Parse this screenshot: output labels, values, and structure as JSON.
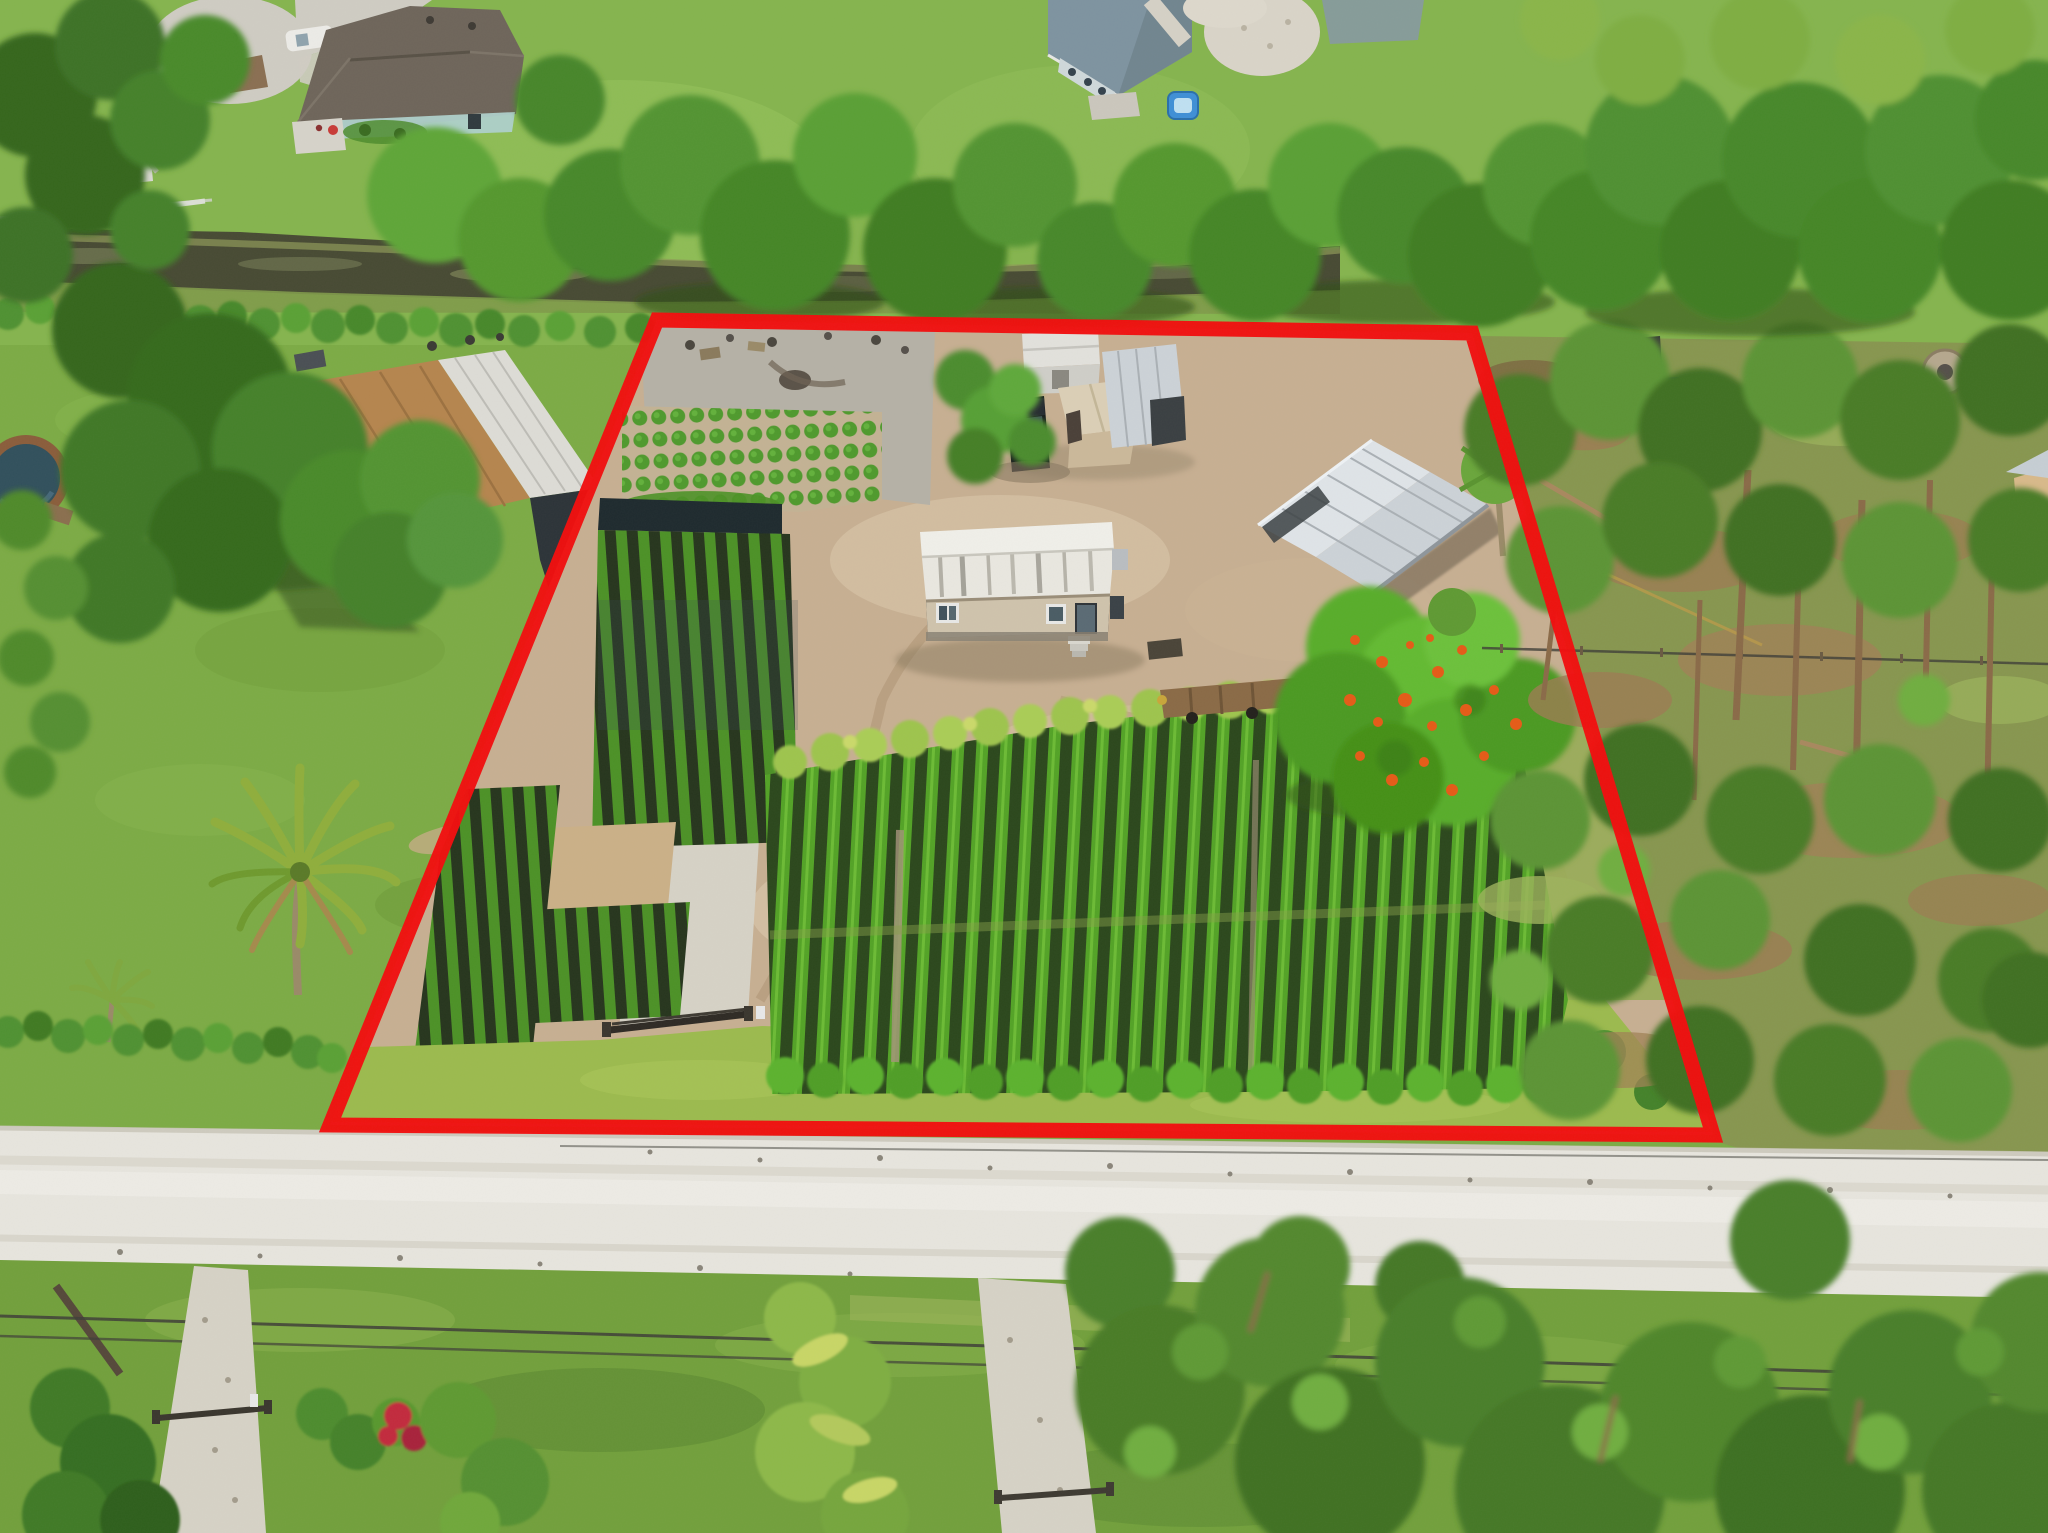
{
  "meta": {
    "type": "aerial-photograph",
    "width": 2048,
    "height": 1533
  },
  "boundary": {
    "points": "657,320 1472,333 1713,1135 330,1125",
    "color": "#f20d0d",
    "stroke_width": 15
  },
  "palette": {
    "lawnTop": "#85b44e",
    "grassWest": "#7cab45",
    "grassSouth": "#72a03c",
    "grassStrip": "#9cba4e",
    "treeDark": "#35661f",
    "treeMid": "#4a8a2a",
    "treeBright": "#62a838",
    "pine": "#4a7c28",
    "pineLight": "#5e9a34",
    "canal": "#474a33",
    "marsh": "#9aa35e",
    "roadLight": "#e7e5de",
    "gravelPath": "#d6d2c6",
    "dirtTan": "#c7af92",
    "gravelGray": "#b5b1a6",
    "bedDark": "#2b471c",
    "rowGreen": "#53a326",
    "bananaGreen": "#9ec44e",
    "hedgeGreen": "#4f9130",
    "roofWhite": "#e9e7e0",
    "roofSilver": "#ccd2d7",
    "roofBrown": "#b5854e",
    "roofDarkHouse": "#6e655a",
    "roofBlueHouse": "#7e93a0",
    "shedTan": "#d3c2a2",
    "wallBeige": "#cfc3ac",
    "wallDark": "#2c3338",
    "tealAccent": "#2e7f8a",
    "truckBlack": "#15181c",
    "poincianaOrange": "#e55b17",
    "poolWater": "#31505c",
    "poolDeck": "#8a5d3b",
    "trunkBrown": "#8a6a48",
    "needleBrown": "#9c7c52",
    "wireDark": "#3f3f38",
    "gateDark": "#2e2a24",
    "playTeal": "#27a398",
    "poolToyBlue": "#3f8fd6",
    "redBush": "#c22a3c"
  },
  "scene": {
    "regions": [
      "north-neighborhood",
      "culdesac-road",
      "house-north-left",
      "house-north-middle",
      "playground",
      "canal",
      "canal-hedge",
      "north-tree-band",
      "west-neighbor-yard",
      "west-barn",
      "above-ground-pool",
      "coconut-palm",
      "southwest-hedge",
      "property-interior",
      "nursery-grid-rows",
      "shade-beds",
      "main-nursery-block",
      "mobile-home",
      "storage-sheds",
      "pickup-truck",
      "metal-barn",
      "flatbed-trailer",
      "poinciana-tree",
      "front-gate",
      "driveway",
      "south-grass-strip",
      "east-pine-forest",
      "dirt-road",
      "south-verge",
      "power-lines",
      "neighbor-driveway-west",
      "neighbor-driveway-south",
      "banana-plants",
      "south-pine-trees",
      "property-boundary"
    ]
  }
}
